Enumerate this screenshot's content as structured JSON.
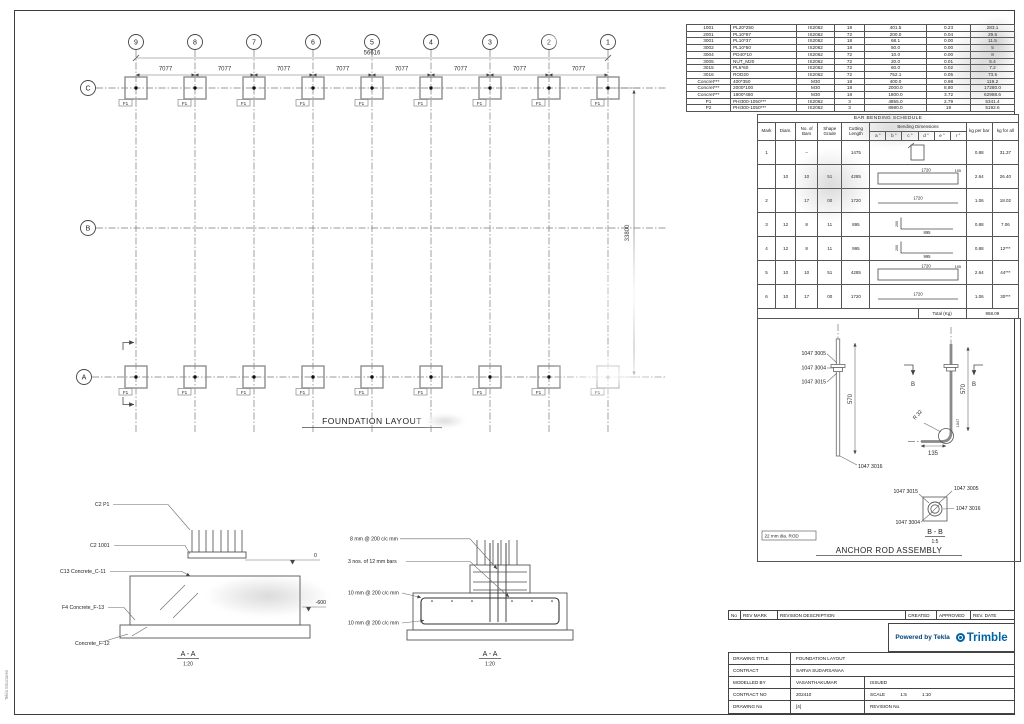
{
  "sheet": {
    "side_text": "Tekla Structures"
  },
  "plan": {
    "title": "FOUNDATION LAYOUT",
    "grid_cols": [
      "9",
      "8",
      "7",
      "6",
      "5",
      "4",
      "3",
      "2",
      "1"
    ],
    "grid_rows": [
      "C",
      "B",
      "A"
    ],
    "spacings": [
      "7077",
      "7077",
      "7077",
      "7077",
      "7077",
      "7077",
      "7077",
      "7077"
    ],
    "total_width": "56616",
    "total_height": "33800",
    "footing_label": "F1"
  },
  "parts_table": {
    "rows": [
      [
        "1001",
        "PL20*250",
        "IS2062",
        "18",
        "401.5",
        "0.23",
        "283.1"
      ],
      [
        "2001",
        "PL10*97",
        "IS2062",
        "72",
        "200.0",
        "0.04",
        "29.6"
      ],
      [
        "3001",
        "PL10*37",
        "IS2062",
        "18",
        "68.1",
        "0.00",
        "11.5"
      ],
      [
        "3002",
        "PL10*50",
        "IS2062",
        "18",
        "50.0",
        "0.00",
        "5"
      ],
      [
        "3004",
        "PD40*10",
        "IS2062",
        "72",
        "10.0",
        "0.00",
        "8"
      ],
      [
        "3005",
        "NUT_M20",
        "IS2062",
        "72",
        "20.0",
        "0.01",
        "5.4"
      ],
      [
        "3015",
        "PL6*60",
        "IS2062",
        "72",
        "60.0",
        "0.02",
        "7.2"
      ],
      [
        "3016",
        "ROD20",
        "IS2062",
        "72",
        "752.1",
        "0.05",
        "73.5"
      ],
      [
        "Concret***",
        "400*350",
        "M30",
        "18",
        "400.0",
        "0.98",
        "119.2"
      ],
      [
        "Concret***",
        "2000*100",
        "M30",
        "18",
        "2000.0",
        "8.80",
        "17280.0"
      ],
      [
        "Concret***",
        "1800*480",
        "M30",
        "18",
        "1800.0",
        "3.72",
        "62988.6"
      ],
      [
        "P1",
        "PHI300-1050***",
        "IS2062",
        "3",
        "4855.0",
        "2.79",
        "5341.4"
      ],
      [
        "P2",
        "PHI300-1050***",
        "IS2062",
        "3",
        "8980.0",
        "19",
        "5192.6"
      ]
    ]
  },
  "bbs": {
    "title": "BAR BENDING SCHEDULE",
    "headers": {
      "mark": "Mark",
      "diam": "Diam.",
      "no": "No. of Bars",
      "grade": "Shape Grade",
      "cut": "Cutting Length",
      "bend": "Bending Dimensions",
      "kg_bar": "kg per bar",
      "kg_all": "kg for all"
    },
    "sub": [
      "a °",
      "b °",
      "c °",
      "d °",
      "e °",
      "r °"
    ],
    "rows": [
      {
        "mark": "1",
        "diam": "",
        "no": "–",
        "grade": "",
        "cut": "1475",
        "d1": "",
        "d2": "",
        "kg_bar": "0.88",
        "kg_all": "31.37"
      },
      {
        "mark": "",
        "diam": "10",
        "no": "10",
        "grade": "51",
        "cut": "4285",
        "d1": "1720",
        "d2": "195",
        "kg_bar": "2.64",
        "kg_all": "26.40"
      },
      {
        "mark": "2",
        "diam": "",
        "no": "17",
        "grade": "00",
        "cut": "1720",
        "d1": "1720",
        "d2": "",
        "kg_bar": "1.06",
        "kg_all": "18.02"
      },
      {
        "mark": "3",
        "diam": "12",
        "no": "8",
        "grade": "11",
        "cut": "895",
        "d1": "895",
        "d2": "200",
        "kg_bar": "0.88",
        "kg_all": "7.06"
      },
      {
        "mark": "4",
        "diam": "12",
        "no": "8",
        "grade": "11",
        "cut": "995",
        "d1": "995",
        "d2": "200",
        "kg_bar": "0.88",
        "kg_all": "12***"
      },
      {
        "mark": "5",
        "diam": "10",
        "no": "10",
        "grade": "51",
        "cut": "4285",
        "d1": "1720",
        "d2": "195",
        "kg_bar": "2.64",
        "kg_all": "44***"
      },
      {
        "mark": "6",
        "diam": "10",
        "no": "17",
        "grade": "00",
        "cut": "1720",
        "d1": "1720",
        "d2": "",
        "kg_bar": "1.06",
        "kg_all": "30***"
      }
    ],
    "total_label": "Total (Kg)",
    "total_value": "958.09"
  },
  "anchor": {
    "title": "ANCHOR ROD ASSEMBLY",
    "note": "22 mm dia. ROD",
    "part_a": "1047 3005",
    "part_b": "1047 3004",
    "part_c": "1047 3015",
    "part_d": "1047 3016",
    "dim_570": "570",
    "dim_1047": "1047",
    "dim_135": "135",
    "radius_label": "R 32",
    "marker_letter": "B",
    "detail_title": "B - B",
    "detail_scale": "1:5"
  },
  "sections": {
    "left": {
      "label_1": "C2 P1",
      "label_2": "C2 1001",
      "label_3": "C13 Concrete_C-11",
      "label_4": "F4 Concrete_F-13",
      "label_5": "Concrete_F-12",
      "elev_top": "0",
      "elev_bottom": "-600",
      "title": "A - A",
      "scale": "1:20"
    },
    "right": {
      "label_1": "8 mm @ 200 c/c mm",
      "label_2": "3 nos. of 12 mm bars",
      "label_3": "10 mm @ 200 c/c mm",
      "label_4": "10 mm @ 200 c/c mm",
      "title": "A - A",
      "scale": "1:20"
    }
  },
  "titleblock": {
    "rev_headers": [
      "No",
      "REV MARK",
      "REVISION DESCRIPTION",
      "CREATED",
      "APPROVED",
      "REV. DATE"
    ],
    "powered_by": "Powered by Tekla",
    "brand": "Trimble",
    "drawing_title_label": "DRAWING TITLE",
    "drawing_title": "FOUNDATION LAYOUT",
    "contract_label": "CONTRACT",
    "contract": "SARVA SUDARSANAA",
    "modelled_by_label": "MODELLED BY",
    "modelled_by": "VASANTHAKUMAR",
    "issued": "ISSUED",
    "contract_no_label": "CONTRACT NO",
    "contract_no": "202410",
    "scale_label": "SCALE",
    "scale_1": "1:5",
    "scale_2": "1:10",
    "drawing_no_label": "DRAWING No",
    "drawing_no": "[4]",
    "revision_no_label": "REVISION No."
  }
}
